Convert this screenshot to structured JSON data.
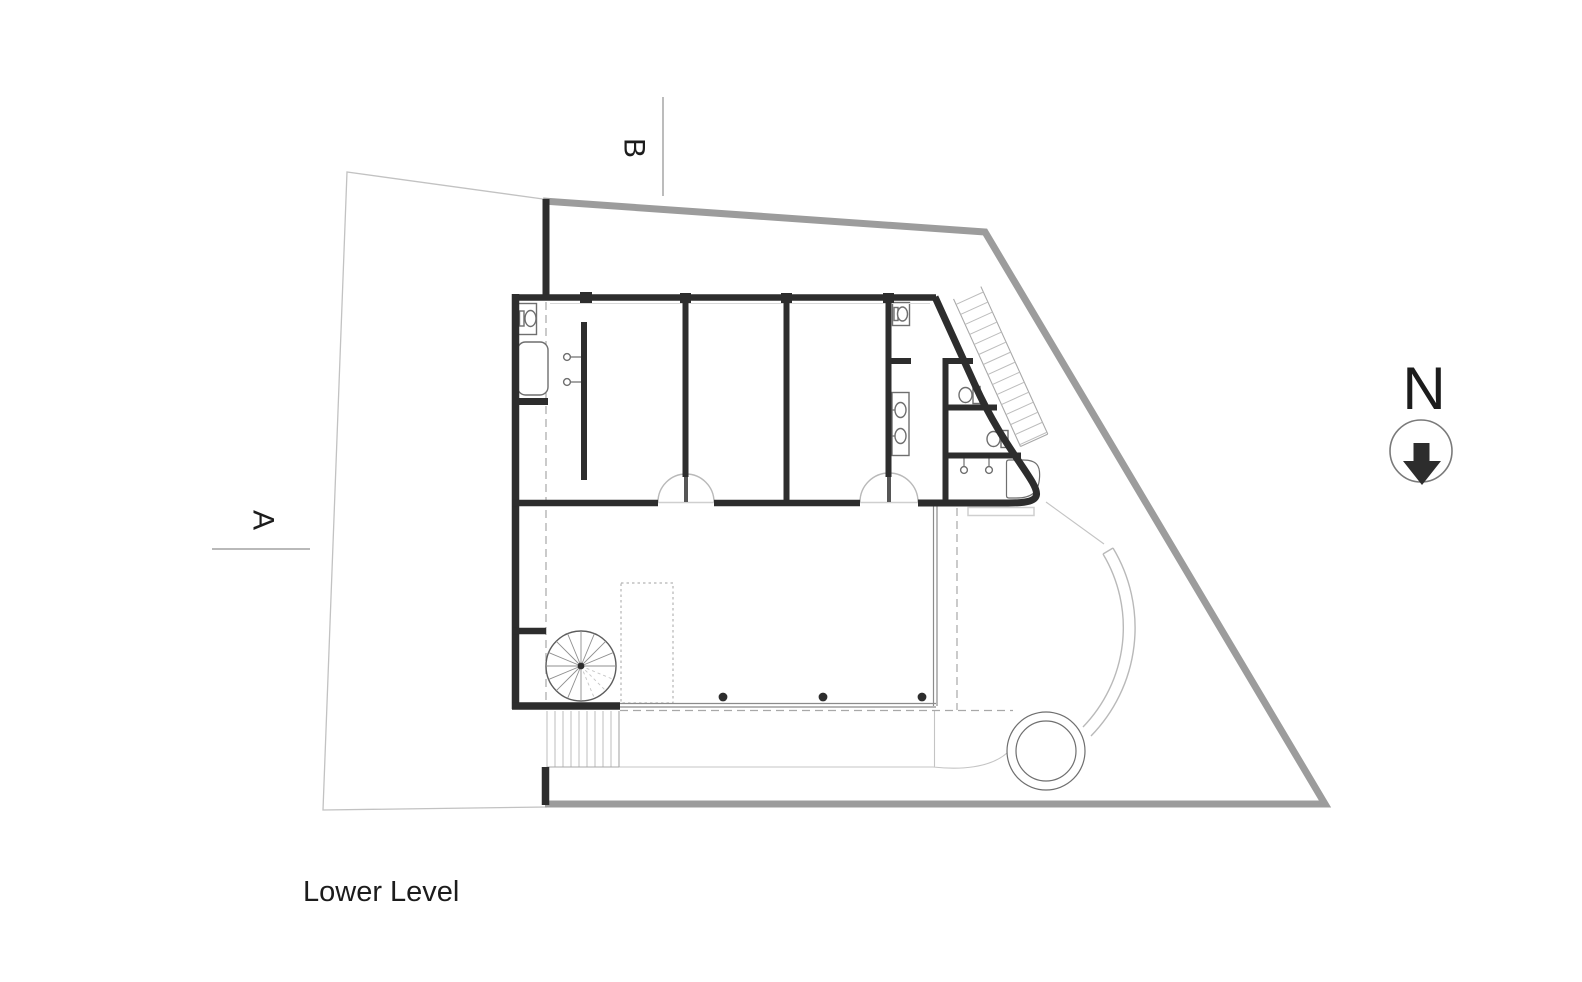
{
  "title": "Lower Level",
  "north_indicator": {
    "label": "N",
    "icon": "arrow-down-icon"
  },
  "section_markers": {
    "a": "A",
    "b": "B"
  },
  "colors": {
    "wall": "#2d2d2d",
    "boundary_heavy": "#9c9c9c",
    "boundary_light": "#c2c2c2",
    "fixture": "#6f6f6f",
    "text": "#1c1c1c"
  }
}
